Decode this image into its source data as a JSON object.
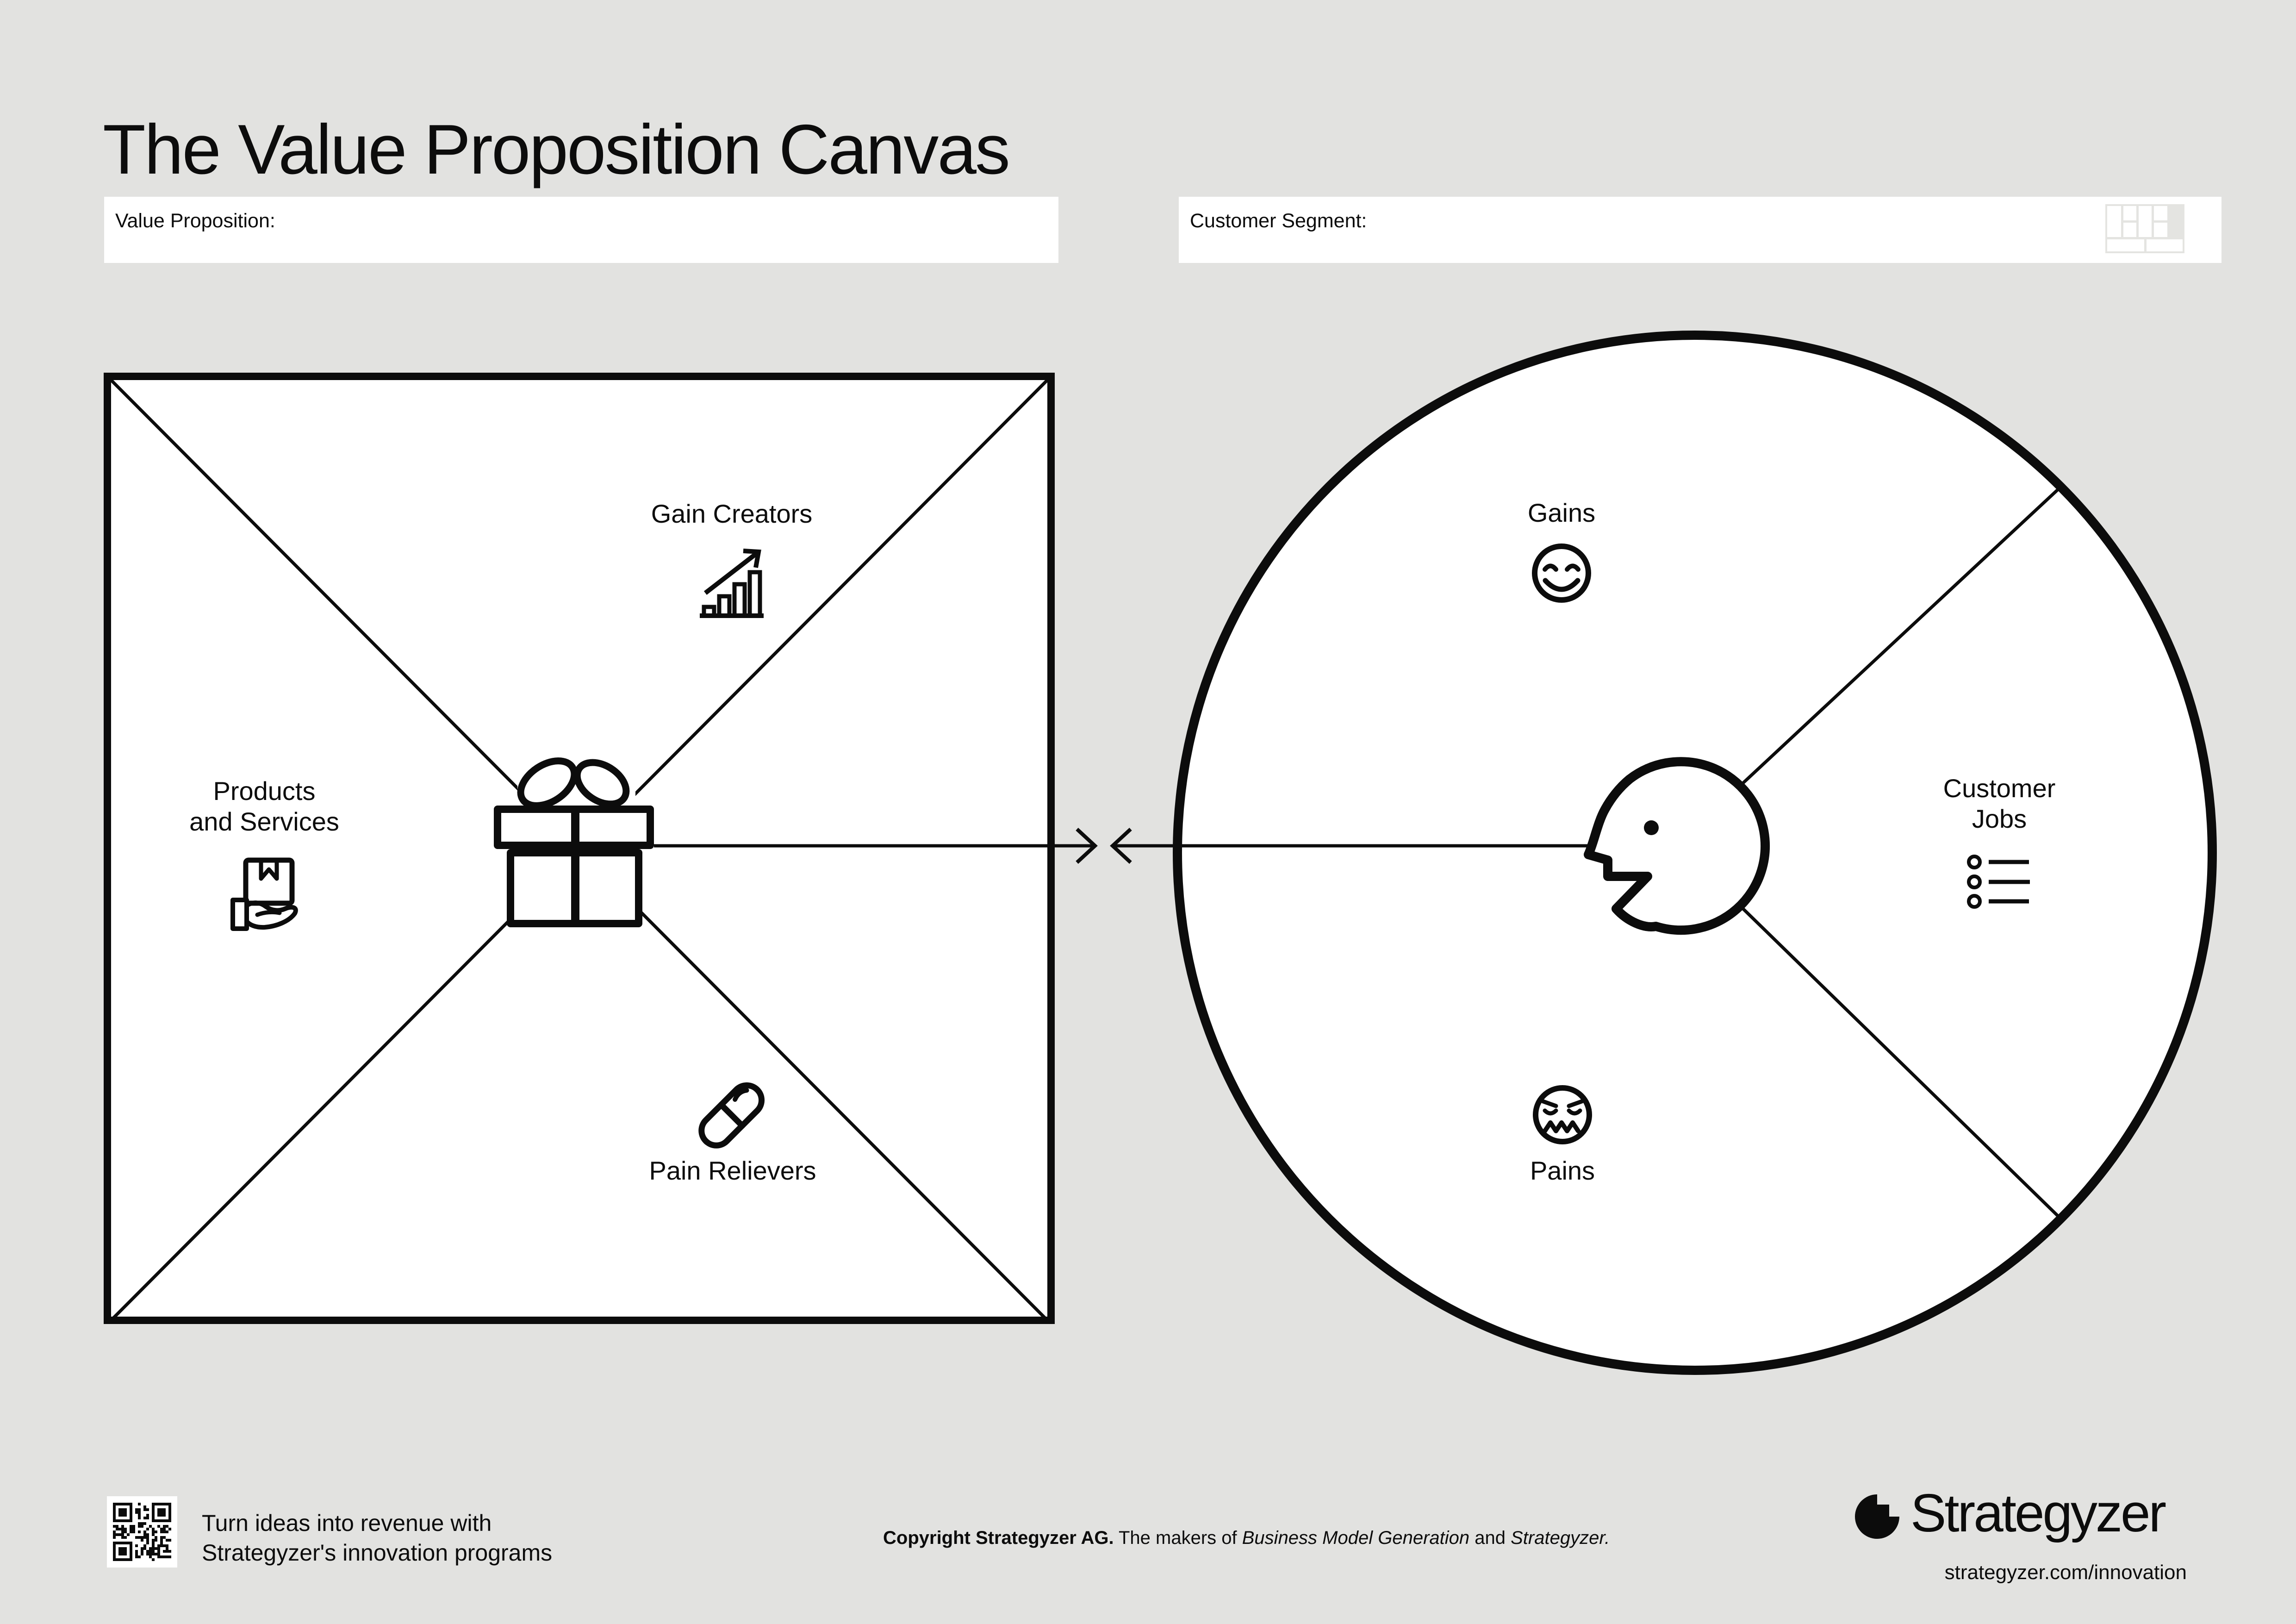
{
  "page": {
    "background_color": "#e2e2e0",
    "ink_color": "#0c0c0c",
    "white": "#ffffff"
  },
  "title": "The Value Proposition Canvas",
  "fields": {
    "value_proposition": {
      "label": "Value Proposition:",
      "value": ""
    },
    "customer_segment": {
      "label": "Customer Segment:",
      "value": ""
    }
  },
  "value_map_square": {
    "gain_creators_label": "Gain Creators",
    "products_label_line1": "Products",
    "products_label_line2": "and Services",
    "pain_relievers_label": "Pain Relievers"
  },
  "customer_profile_circle": {
    "gains_label": "Gains",
    "customer_jobs_label_line1": "Customer",
    "customer_jobs_label_line2": "Jobs",
    "pains_label": "Pains"
  },
  "footer": {
    "promo_line1": "Turn ideas into revenue with",
    "promo_line2": "Strategyzer's innovation programs",
    "copyright_bold": "Copyright Strategyzer AG.",
    "copyright_regular": " The makers of ",
    "copyright_italic1": "Business Model Generation",
    "copyright_and": " and ",
    "copyright_italic2": "Strategyzer.",
    "logo_text": "Strategyzer",
    "website": "strategyzer.com/innovation"
  },
  "icons": {
    "gain_creators": "bar-chart-rising-arrow-icon",
    "products_and_services": "hand-holding-box-icon",
    "pain_relievers": "pill-icon",
    "gift_center": "gift-box-icon",
    "gains": "happy-face-icon",
    "pains": "confounded-face-icon",
    "customer_jobs": "bullet-list-icon",
    "head_center": "customer-head-profile-icon",
    "customer_segment_field": "business-model-canvas-icon",
    "footer_left": "qr-code-icon",
    "footer_right": "strategyzer-logo-icon"
  }
}
